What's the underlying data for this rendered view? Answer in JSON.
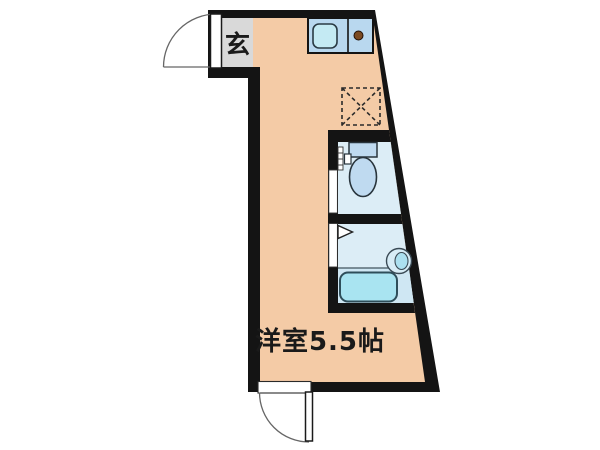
{
  "plan": {
    "type": "apartment-floor-plan",
    "labels": {
      "entrance": "玄",
      "main_room": "洋室5.5帖"
    },
    "colors": {
      "background": "#ffffff",
      "wall": "#141414",
      "room_floor": "#f4cba6",
      "entrance_floor": "#d9d9d9",
      "wet_floor": "#dcedf6",
      "wet_floor_lower": "#cfe7f3",
      "counter": "#b9d8ef",
      "sink": "#c4eaf3",
      "fixture": "#bfdaf0",
      "bathtub": "#a9e4f1",
      "burner": "#7b4a22",
      "door_arc": "#666666"
    },
    "rooms": [
      {
        "name": "entrance",
        "label": "玄"
      },
      {
        "name": "western-room",
        "label": "洋室5.5帖"
      },
      {
        "name": "toilet",
        "label": ""
      },
      {
        "name": "bathroom",
        "label": ""
      }
    ]
  }
}
